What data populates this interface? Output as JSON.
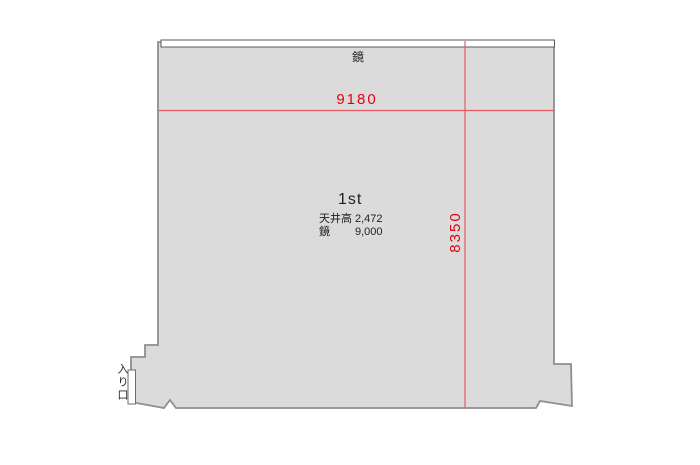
{
  "floorplan": {
    "room_name": "1st",
    "mirror_label": "鏡",
    "entrance_label": "入り口",
    "dimensions": {
      "width": "9180",
      "depth": "8350"
    },
    "specs": [
      {
        "label": "天井高",
        "value": "2,472"
      },
      {
        "label": "鏡",
        "value": "9,000"
      }
    ],
    "colors": {
      "room_fill": "#dbdbdb",
      "outline": "#8f8f8f",
      "mirror_stroke": "#5a5a5a",
      "dimension_line": "#e55a64",
      "dimension_text": "#e60012",
      "text": "#2a2a2a"
    }
  }
}
